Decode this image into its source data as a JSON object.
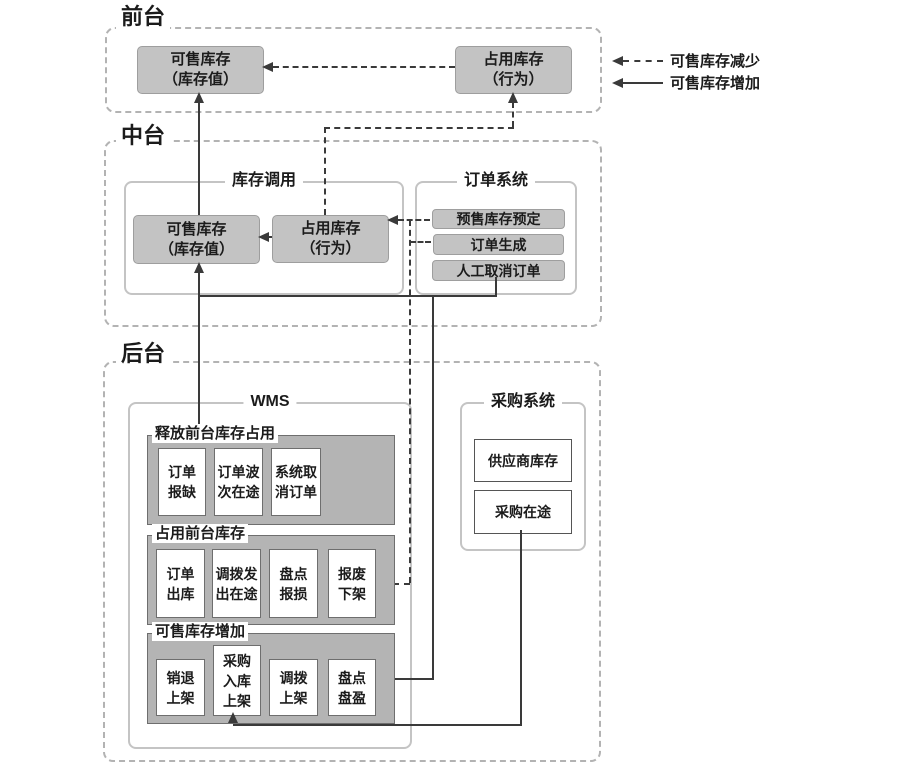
{
  "legend": {
    "decrease_label": "可售库存减少",
    "increase_label": "可售库存增加"
  },
  "sections": {
    "front": {
      "title": "前台"
    },
    "middle": {
      "title": "中台"
    },
    "back": {
      "title": "后台"
    }
  },
  "front": {
    "sellable": [
      "可售库存",
      "（库存值）"
    ],
    "occupied": [
      "占用库存",
      "（行为）"
    ]
  },
  "middle": {
    "inventory_call": {
      "title": "库存调用",
      "sellable": [
        "可售库存",
        "（库存值）"
      ],
      "occupied": [
        "占用库存",
        "（行为）"
      ]
    },
    "order_system": {
      "title": "订单系统",
      "items": [
        "预售库存预定",
        "订单生成",
        "人工取消订单"
      ]
    }
  },
  "back": {
    "wms": {
      "title": "WMS",
      "release_group": {
        "label": "释放前台库存占用",
        "items": [
          [
            "订单",
            "报缺"
          ],
          [
            "订单波",
            "次在途"
          ],
          [
            "系统取",
            "消订单"
          ]
        ]
      },
      "occupy_group": {
        "label": "占用前台库存",
        "items": [
          [
            "订单",
            "出库"
          ],
          [
            "调拨发",
            "出在途"
          ],
          [
            "盘点",
            "报损"
          ],
          [
            "报废",
            "下架"
          ]
        ]
      },
      "increase_group": {
        "label": "可售库存增加",
        "items": [
          [
            "销退",
            "上架"
          ],
          [
            "采购",
            "入库",
            "上架"
          ],
          [
            "调拨",
            "上架"
          ],
          [
            "盘点",
            "盘盈"
          ]
        ]
      }
    },
    "purchase_system": {
      "title": "采购系统",
      "items": [
        "供应商库存",
        "采购在途"
      ]
    }
  },
  "colors": {
    "node_fill": "#c3c3c3",
    "group_fill": "#b4b4b4",
    "line": "#3a3a3a",
    "section_border": "#b3b3b3"
  }
}
